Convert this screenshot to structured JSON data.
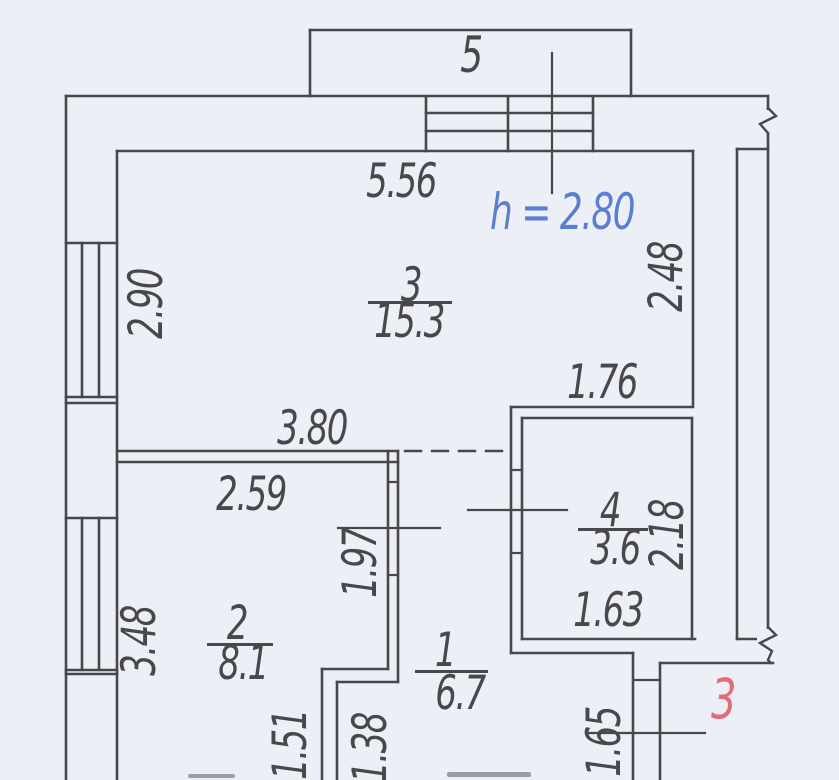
{
  "plan": {
    "balcony_label": "5",
    "ceiling_height_note": "h = 2.80",
    "entrance_label": "3"
  },
  "rooms": [
    {
      "id": "room-3",
      "number": "3",
      "area": "15.3"
    },
    {
      "id": "room-2",
      "number": "2",
      "area": "8.1"
    },
    {
      "id": "room-1",
      "number": "1",
      "area": "6.7"
    },
    {
      "id": "room-4",
      "number": "4",
      "area": "3.6"
    }
  ],
  "dimensions": [
    {
      "id": "top-wall-width",
      "value": "5.56",
      "orientation": "horizontal"
    },
    {
      "id": "left-window-upper",
      "value": "2.90",
      "orientation": "vertical"
    },
    {
      "id": "room3-right-height",
      "value": "2.48",
      "orientation": "vertical"
    },
    {
      "id": "room4-top-width",
      "value": "1.76",
      "orientation": "horizontal"
    },
    {
      "id": "room3-bottom-width",
      "value": "3.80",
      "orientation": "horizontal"
    },
    {
      "id": "room2-top-width",
      "value": "2.59",
      "orientation": "horizontal"
    },
    {
      "id": "corridor-door-height",
      "value": "1.97",
      "orientation": "vertical"
    },
    {
      "id": "room4-right-height",
      "value": "2.18",
      "orientation": "vertical"
    },
    {
      "id": "room4-bottom-width",
      "value": "1.63",
      "orientation": "horizontal"
    },
    {
      "id": "left-window-lower",
      "value": "3.48",
      "orientation": "vertical"
    },
    {
      "id": "room2-lower-right",
      "value": "1.51",
      "orientation": "vertical"
    },
    {
      "id": "corridor-lower",
      "value": "1.38",
      "orientation": "vertical"
    },
    {
      "id": "entrance-wall",
      "value": "1.65",
      "orientation": "vertical"
    }
  ],
  "colors": {
    "line": "#47474c",
    "height_note_blue": "#5b7fd0",
    "entrance_red": "#e26b78",
    "paper": "#edeff7"
  }
}
